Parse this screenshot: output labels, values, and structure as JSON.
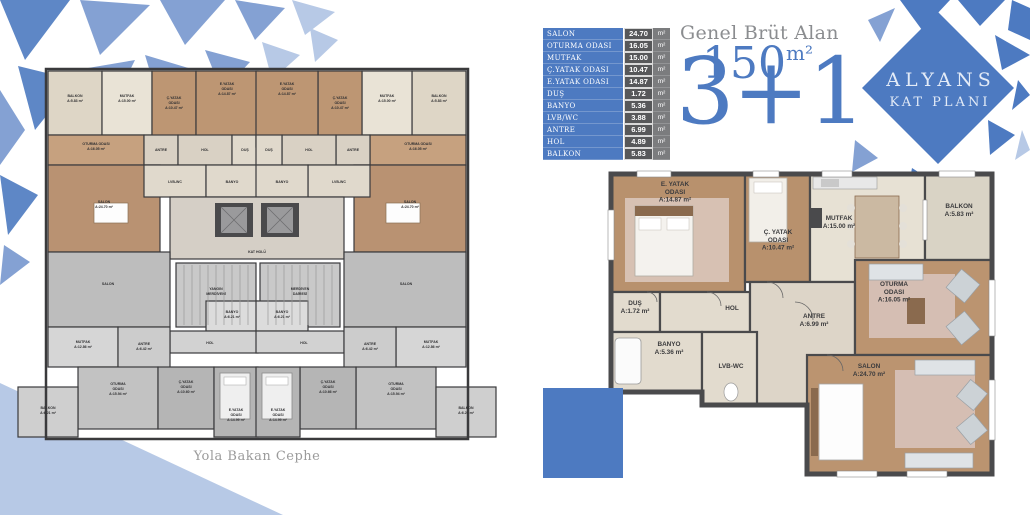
{
  "colors": {
    "accent": "#4d7ac1",
    "shard_light": "#84a1d3",
    "shard_pale": "#b7c9e6",
    "table_value_bg": "#57585a",
    "table_unit_bg": "#7b7c7e",
    "muted_text": "#8b8d90"
  },
  "logo": {
    "line1": "ALYANS",
    "line2": "KAT PLANI"
  },
  "headline": {
    "label": "Genel Brüt Alan",
    "area": "150",
    "area_unit": "m²",
    "type": "3+1"
  },
  "area_table": {
    "unit_label": "m²",
    "rows": [
      {
        "name": "SALON",
        "value": "24.70"
      },
      {
        "name": "OTURMA ODASI",
        "value": "16.05"
      },
      {
        "name": "MUTFAK",
        "value": "15.00"
      },
      {
        "name": "Ç.YATAK ODASI",
        "value": "10.47"
      },
      {
        "name": "E.YATAK ODASI",
        "value": "14.87"
      },
      {
        "name": "DUŞ",
        "value": "1.72"
      },
      {
        "name": "BANYO",
        "value": "5.36"
      },
      {
        "name": "LVB/WC",
        "value": "3.88"
      },
      {
        "name": "ANTRE",
        "value": "6.99"
      },
      {
        "name": "HOL",
        "value": "4.89"
      },
      {
        "name": "BALKON",
        "value": "5.83"
      }
    ]
  },
  "left_plan": {
    "caption": "Yola Bakan Cephe",
    "fs": 3.5,
    "lh": 4.9,
    "sw": 1.2,
    "wall": "#3a3a3c",
    "label_color": "#2f2f31",
    "rooms": [
      {
        "x": 38,
        "y": 14,
        "w": 54,
        "h": 64,
        "f": "#ded6c6",
        "lines": [
          "BALKON",
          "A:5.83 m²"
        ],
        "lx": 65,
        "ly": 40
      },
      {
        "x": 92,
        "y": 14,
        "w": 50,
        "h": 64,
        "f": "#e9e3d6",
        "lines": [
          "MUTFAK",
          "A:15.00 m²"
        ],
        "lx": 117,
        "ly": 40
      },
      {
        "x": 142,
        "y": 14,
        "w": 44,
        "h": 76,
        "f": "#bd9673",
        "lines": [
          "Ç.YATAK",
          "ODASI",
          "A:10.47 m²"
        ],
        "lx": 164,
        "ly": 42
      },
      {
        "x": 186,
        "y": 14,
        "w": 62,
        "h": 76,
        "f": "#bd9673",
        "lines": [
          "E.YATAK",
          "ODASI",
          "A:14.87 m²"
        ],
        "lx": 217,
        "ly": 28
      },
      {
        "x": 38,
        "y": 78,
        "w": 96,
        "h": 30,
        "f": "#c6a17f",
        "lines": [
          "OTURMA ODASI",
          "A:16.05 m²"
        ],
        "lx": 86,
        "ly": 88
      },
      {
        "x": 134,
        "y": 78,
        "w": 34,
        "h": 30,
        "f": "#d9d1c4",
        "lines": [
          "ANTRE"
        ],
        "lx": 151,
        "ly": 94
      },
      {
        "x": 168,
        "y": 78,
        "w": 54,
        "h": 30,
        "f": "#d9d1c4",
        "lines": [
          "HOL"
        ],
        "lx": 195,
        "ly": 94
      },
      {
        "x": 222,
        "y": 78,
        "w": 26,
        "h": 30,
        "f": "#e0d9cc",
        "lines": [
          "DUŞ"
        ],
        "lx": 235,
        "ly": 94
      },
      {
        "x": 38,
        "y": 108,
        "w": 112,
        "h": 87,
        "f": "#b99272",
        "lines": [
          "SALON",
          "A:24.70 m²"
        ],
        "lx": 94,
        "ly": 146
      },
      {
        "x": 134,
        "y": 108,
        "w": 62,
        "h": 32,
        "f": "#e0d9cc",
        "lines": [
          "LVB-WC"
        ],
        "lx": 165,
        "ly": 126
      },
      {
        "x": 196,
        "y": 108,
        "w": 52,
        "h": 32,
        "f": "#e0d9cc",
        "lines": [
          "BANYO"
        ],
        "lx": 222,
        "ly": 126
      },
      {
        "x": 402,
        "y": 14,
        "w": 54,
        "h": 64,
        "f": "#ded6c6",
        "lines": [
          "BALKON",
          "A:5.83 m²"
        ],
        "lx": 429,
        "ly": 40
      },
      {
        "x": 352,
        "y": 14,
        "w": 50,
        "h": 64,
        "f": "#e9e3d6",
        "lines": [
          "MUTFAK",
          "A:15.00 m²"
        ],
        "lx": 377,
        "ly": 40
      },
      {
        "x": 308,
        "y": 14,
        "w": 44,
        "h": 76,
        "f": "#bd9673",
        "lines": [
          "Ç.YATAK",
          "ODASI",
          "A:10.47 m²"
        ],
        "lx": 330,
        "ly": 42
      },
      {
        "x": 246,
        "y": 14,
        "w": 62,
        "h": 76,
        "f": "#bd9673",
        "lines": [
          "E.YATAK",
          "ODASI",
          "A:14.87 m²"
        ],
        "lx": 277,
        "ly": 28
      },
      {
        "x": 360,
        "y": 78,
        "w": 96,
        "h": 30,
        "f": "#c6a17f",
        "lines": [
          "OTURMA ODASI",
          "A:16.05 m²"
        ],
        "lx": 408,
        "ly": 88
      },
      {
        "x": 326,
        "y": 78,
        "w": 34,
        "h": 30,
        "f": "#d9d1c4",
        "lines": [
          "ANTRE"
        ],
        "lx": 343,
        "ly": 94
      },
      {
        "x": 272,
        "y": 78,
        "w": 54,
        "h": 30,
        "f": "#d9d1c4",
        "lines": [
          "HOL"
        ],
        "lx": 299,
        "ly": 94
      },
      {
        "x": 246,
        "y": 78,
        "w": 26,
        "h": 30,
        "f": "#e0d9cc",
        "lines": [
          "DUŞ"
        ],
        "lx": 259,
        "ly": 94
      },
      {
        "x": 344,
        "y": 108,
        "w": 112,
        "h": 87,
        "f": "#b99272",
        "lines": [
          "SALON",
          "A:24.70 m²"
        ],
        "lx": 400,
        "ly": 146
      },
      {
        "x": 298,
        "y": 108,
        "w": 62,
        "h": 32,
        "f": "#e0d9cc",
        "lines": [
          "LVB-WC"
        ],
        "lx": 329,
        "ly": 126
      },
      {
        "x": 246,
        "y": 108,
        "w": 52,
        "h": 32,
        "f": "#e0d9cc",
        "lines": [
          "BANYO"
        ],
        "lx": 272,
        "ly": 126
      },
      {
        "x": 160,
        "y": 140,
        "w": 174,
        "h": 62,
        "f": "#d5cfc6",
        "lines": [
          "KAT HOLÜ"
        ],
        "lx": 247,
        "ly": 196
      },
      {
        "x": 166,
        "y": 206,
        "w": 80,
        "h": 64,
        "f": "#c9c9c9",
        "lines": [
          "YANGIN",
          "MERDİVENİ"
        ],
        "lx": 206,
        "ly": 233
      },
      {
        "x": 250,
        "y": 206,
        "w": 80,
        "h": 64,
        "f": "#c9c9c9",
        "lines": [
          "MERDİVEN",
          "DAİRESİ"
        ],
        "lx": 290,
        "ly": 233
      },
      {
        "x": 38,
        "y": 195,
        "w": 122,
        "h": 75,
        "f": "#bdbdbd",
        "lines": [
          "SALON"
        ],
        "lx": 98,
        "ly": 228
      },
      {
        "x": 196,
        "y": 244,
        "w": 52,
        "h": 30,
        "f": "#dcdcdc",
        "lines": [
          "BANYO",
          "A:6.21 m²"
        ],
        "lx": 222,
        "ly": 256
      },
      {
        "x": 160,
        "y": 274,
        "w": 88,
        "h": 22,
        "f": "#d2d2d2",
        "lines": [
          "HOL"
        ],
        "lx": 200,
        "ly": 287
      },
      {
        "x": 38,
        "y": 270,
        "w": 70,
        "h": 40,
        "f": "#d6d6d6",
        "lines": [
          "MUTFAK",
          "A:12.86 m²"
        ],
        "lx": 73,
        "ly": 286
      },
      {
        "x": 108,
        "y": 270,
        "w": 52,
        "h": 45,
        "f": "#cccccc",
        "lines": [
          "ANTRE",
          "A:6.42 m²"
        ],
        "lx": 134,
        "ly": 288
      },
      {
        "x": 68,
        "y": 310,
        "w": 80,
        "h": 62,
        "f": "#c2c2c2",
        "lines": [
          "OTURMA",
          "ODASI",
          "A:15.94 m²"
        ],
        "lx": 108,
        "ly": 328
      },
      {
        "x": 8,
        "y": 330,
        "w": 60,
        "h": 50,
        "f": "#cfcfcf",
        "lines": [
          "BALKON",
          "A:6.21 m²"
        ],
        "lx": 38,
        "ly": 352
      },
      {
        "x": 148,
        "y": 310,
        "w": 56,
        "h": 62,
        "f": "#b5b5b5",
        "lines": [
          "Ç.YATAK",
          "ODASI",
          "A:10.60 m²"
        ],
        "lx": 176,
        "ly": 326
      },
      {
        "x": 204,
        "y": 310,
        "w": 44,
        "h": 70,
        "f": "#b5b5b5",
        "lines": [
          "E.YATAK",
          "ODASI",
          "A:14.99 m²"
        ],
        "lx": 226,
        "ly": 354
      },
      {
        "x": 334,
        "y": 195,
        "w": 122,
        "h": 75,
        "f": "#bdbdbd",
        "lines": [
          "SALON"
        ],
        "lx": 396,
        "ly": 228
      },
      {
        "x": 246,
        "y": 244,
        "w": 52,
        "h": 30,
        "f": "#dcdcdc",
        "lines": [
          "BANYO",
          "A:6.21 m²"
        ],
        "lx": 272,
        "ly": 256
      },
      {
        "x": 246,
        "y": 274,
        "w": 88,
        "h": 22,
        "f": "#d2d2d2",
        "lines": [
          "HOL"
        ],
        "lx": 294,
        "ly": 287
      },
      {
        "x": 386,
        "y": 270,
        "w": 70,
        "h": 40,
        "f": "#d6d6d6",
        "lines": [
          "MUTFAK",
          "A:12.86 m²"
        ],
        "lx": 421,
        "ly": 286
      },
      {
        "x": 334,
        "y": 270,
        "w": 52,
        "h": 45,
        "f": "#cccccc",
        "lines": [
          "ANTRE",
          "A:6.42 m²"
        ],
        "lx": 360,
        "ly": 288
      },
      {
        "x": 346,
        "y": 310,
        "w": 80,
        "h": 62,
        "f": "#c2c2c2",
        "lines": [
          "OTURMA",
          "ODASI",
          "A:15.94 m²"
        ],
        "lx": 386,
        "ly": 328
      },
      {
        "x": 426,
        "y": 330,
        "w": 60,
        "h": 50,
        "f": "#cfcfcf",
        "lines": [
          "BALKON",
          "A:6.21 m²"
        ],
        "lx": 456,
        "ly": 352
      },
      {
        "x": 290,
        "y": 310,
        "w": 56,
        "h": 62,
        "f": "#b5b5b5",
        "lines": [
          "Ç.YATAK",
          "ODASI",
          "A:10.66 m²"
        ],
        "lx": 318,
        "ly": 326
      },
      {
        "x": 246,
        "y": 310,
        "w": 44,
        "h": 70,
        "f": "#b5b5b5",
        "lines": [
          "E.YATAK",
          "ODASI",
          "A:14.99 m²"
        ],
        "lx": 268,
        "ly": 354
      }
    ]
  },
  "right_plan": {
    "fs": 6.4,
    "lh": 7.8,
    "sw": 2.2,
    "wall": "#4a4a4c",
    "label_color": "#3b3b3d",
    "rooms": [
      {
        "x": 4,
        "y": 4,
        "w": 134,
        "h": 118,
        "f": "#b8916d",
        "lines": [
          "E. YATAK",
          "ODASI",
          "A:14.87 m²"
        ],
        "lx": 68,
        "ly": 16
      },
      {
        "x": 138,
        "y": 4,
        "w": 65,
        "h": 108,
        "f": "#b8916d",
        "lines": [
          "Ç. YATAK",
          "ODASI",
          "A:10.47 m²"
        ],
        "lx": 171,
        "ly": 64
      },
      {
        "x": 203,
        "y": 4,
        "w": 115,
        "h": 108,
        "f": "#e7e1d4",
        "lines": [
          "MUTFAK",
          "A:15.00 m²"
        ],
        "lx": 232,
        "ly": 50
      },
      {
        "x": 318,
        "y": 4,
        "w": 67,
        "h": 86,
        "f": "#d9d3c5",
        "lines": [
          "BALKON",
          "A:5.83 m²"
        ],
        "lx": 352,
        "ly": 38
      },
      {
        "x": 4,
        "y": 122,
        "w": 49,
        "h": 40,
        "f": "#e2dbce",
        "lines": [
          "DUŞ",
          "A:1.72 m²"
        ],
        "lx": 28,
        "ly": 135
      },
      {
        "x": 53,
        "y": 122,
        "w": 90,
        "h": 40,
        "f": "#e2dbce",
        "lines": [
          "HOL"
        ],
        "lx": 125,
        "ly": 140
      },
      {
        "x": 143,
        "y": 112,
        "w": 105,
        "h": 123,
        "f": "#ddd5c8",
        "lines": [
          "ANTRE",
          "A:6.99 m²"
        ],
        "lx": 207,
        "ly": 148
      },
      {
        "x": 4,
        "y": 162,
        "w": 91,
        "h": 60,
        "f": "#e2dbce",
        "lines": [
          "BANYO",
          "A:5.36 m²"
        ],
        "lx": 62,
        "ly": 176
      },
      {
        "x": 95,
        "y": 162,
        "w": 55,
        "h": 73,
        "f": "#e2dbce",
        "lines": [
          "LVB-WC"
        ],
        "lx": 124,
        "ly": 198
      },
      {
        "x": 248,
        "y": 90,
        "w": 137,
        "h": 95,
        "f": "#bb9470",
        "lines": [
          "OTURMA",
          "ODASI",
          "A:16.05 m²"
        ],
        "lx": 287,
        "ly": 116
      },
      {
        "x": 200,
        "y": 185,
        "w": 185,
        "h": 119,
        "f": "#bb9470",
        "lines": [
          "SALON",
          "A:24.70 m²"
        ],
        "lx": 262,
        "ly": 198
      }
    ]
  }
}
